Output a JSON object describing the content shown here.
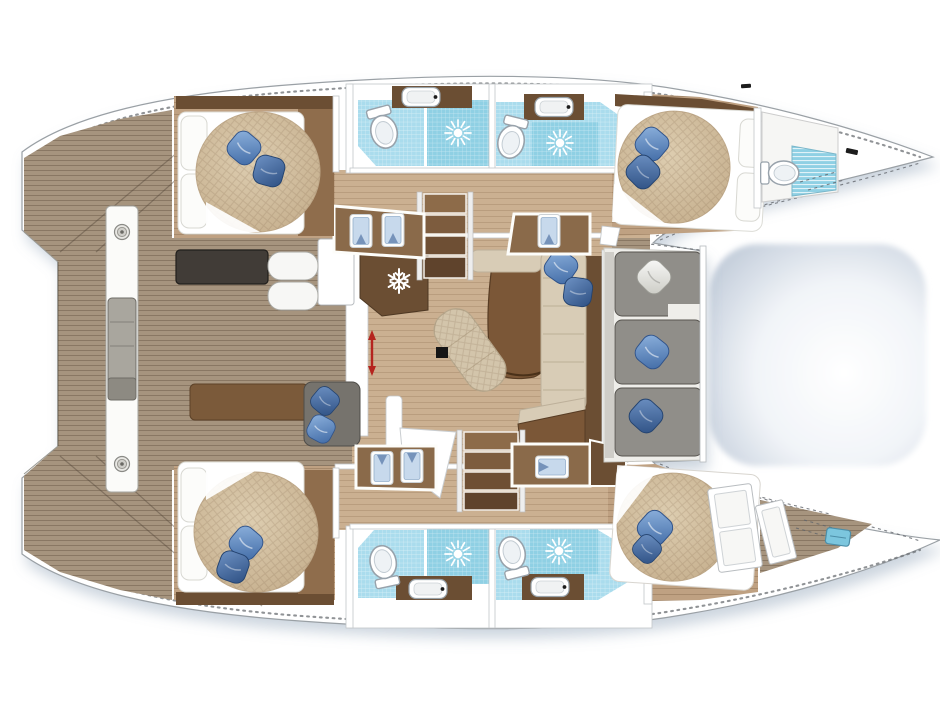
{
  "meta": {
    "kind": "floor-plan",
    "label": "Catamaran sailing yacht — top-down deck and accommodation plan",
    "view": "overhead layout drawing, bows to the right, sterns to the left",
    "no_visible_text": true
  },
  "colors": {
    "outline": "#8a8f94",
    "hull_white": "#ffffff",
    "shadow": "#8195ad",
    "teak": "#a6947e",
    "deck_seam": "#55483a",
    "salon_floor": "#cbb091",
    "cabin_floor": "#bfa182",
    "wood_dark": "#6b4e33",
    "wood_mid": "#8a6a4a",
    "table_wood": "#7b5737",
    "counter_charcoal": "#413c37",
    "mattress": "#d2bf9f",
    "sofa_cream": "#d8ccb6",
    "pillow_blue": "#5b82b8",
    "pillow_navy": "#3c5f92",
    "pillow_white": "#e8e8e4",
    "tile": "#aadced",
    "shower_tile": "#8fd0e4",
    "sofa_gray": "#908e89",
    "cushion_pad": "#a9a69e",
    "wall": "#ffffff",
    "arrow_red": "#b5241e",
    "hatch_blue": "#7cc6de",
    "trampoline_edge": "#c4cedb"
  },
  "areas": [
    {
      "id": "aft-deck",
      "label": "Aft deck with teak planking and transom steps"
    },
    {
      "id": "aft-cockpit",
      "label": "Aft cockpit with bench, seat pads and traveler beam"
    },
    {
      "id": "salon",
      "label": "Salon with dining table, chaise and L-sofa"
    },
    {
      "id": "galley",
      "label": "Galley block with fridge (snowflake) and counters"
    },
    {
      "id": "cabin-port-aft",
      "label": "Port aft double cabin"
    },
    {
      "id": "cabin-port-fwd",
      "label": "Port forward double cabin"
    },
    {
      "id": "cabin-stbd-aft",
      "label": "Starboard aft double cabin"
    },
    {
      "id": "cabin-stbd-fwd",
      "label": "Starboard forward double cabin"
    },
    {
      "id": "bathrooms-port",
      "label": "Two port bathrooms with toilet, sink and shower"
    },
    {
      "id": "bathrooms-stbd",
      "label": "Two starboard bathrooms with toilet, sink and shower"
    },
    {
      "id": "bow-head",
      "label": "Forepeak head with toilet in port bow"
    },
    {
      "id": "forepeak",
      "label": "Starboard forepeak locker with doors and deck hatch"
    },
    {
      "id": "forward-cockpit",
      "label": "Forward cockpit with grey L-sofa and cushions"
    },
    {
      "id": "trampoline",
      "label": "Bow trampoline between the hulls"
    },
    {
      "id": "stairs-port",
      "label": "Companionway steps down to port hull"
    },
    {
      "id": "stairs-stbd",
      "label": "Companionway steps down to starboard hull"
    }
  ],
  "furniture_icons": {
    "double_beds": 4,
    "toilets": 5,
    "shower_drain_suns": 4,
    "sinks": 4,
    "wardrobe_shirt_panels": 4,
    "fridge_snowflake": 1,
    "sliding_door_red_arrow": 1,
    "stair_flights": 2,
    "deck_winches": 2,
    "deck_hatch": 1,
    "blue_throw_pillows": 14,
    "white_throw_pillows": 2
  }
}
